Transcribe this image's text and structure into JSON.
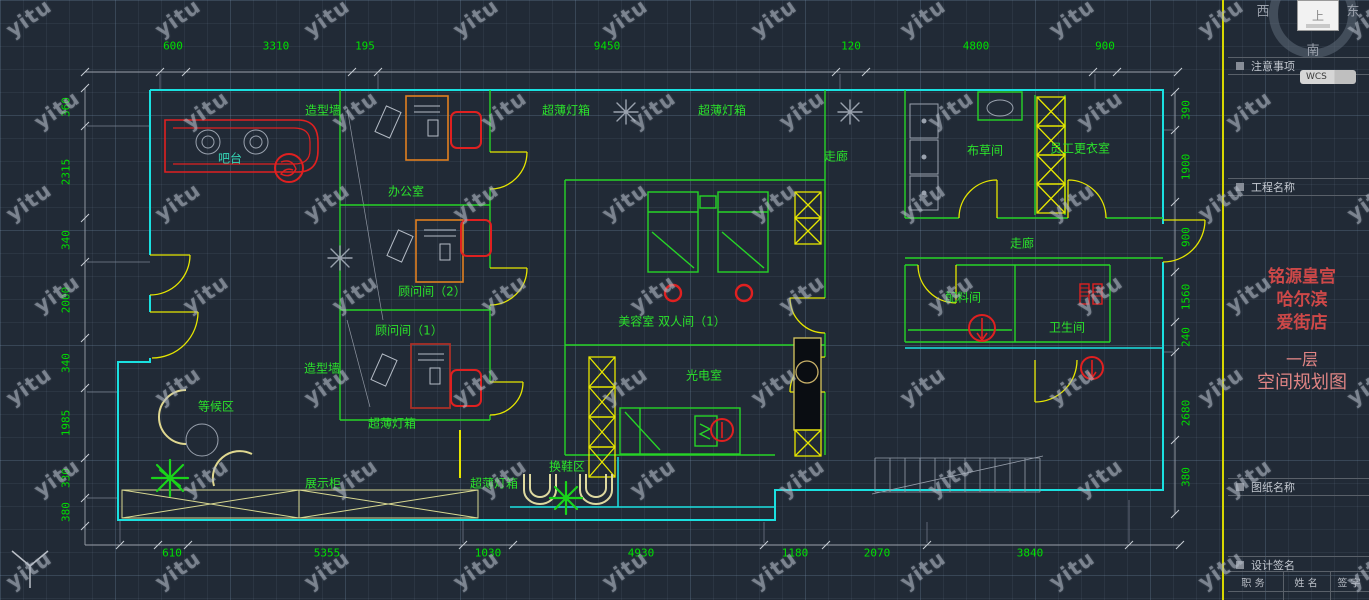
{
  "watermark": {
    "text": "yitu"
  },
  "compass": {
    "west": "西",
    "east": "东",
    "south": "南",
    "top": "上"
  },
  "colors": {
    "walls": "#1ae0e0",
    "partitions": "#27d427",
    "fixtures": "#e6e600",
    "highlight": "#e02020",
    "dim_text": "#00e000",
    "title_red": "#cd4848"
  },
  "sidebar": {
    "wcs_label": "WCS",
    "sections": {
      "notes": "注意事项",
      "project": "工程名称",
      "sheet": "图纸名称",
      "sign": "设计签名"
    },
    "title": {
      "line1": "铭源皇宫",
      "line2": "哈尔滨",
      "line3": "爱街店"
    },
    "subtitle": {
      "line1": "一层",
      "line2": "空间规划图"
    },
    "sign_table": {
      "col1": "职  务",
      "col2": "姓  名",
      "col3": "签  字"
    }
  },
  "dims": {
    "top": [
      "600",
      "3310",
      "195",
      "9450",
      "120",
      "4800",
      "900"
    ],
    "bottom": [
      "610",
      "5355",
      "1030",
      "4930",
      "1180",
      "2070",
      "3840"
    ],
    "left": [
      "360",
      "2315",
      "340",
      "2000",
      "340",
      "1985",
      "330",
      "380"
    ],
    "right": [
      "390",
      "1900",
      "900",
      "1560",
      "240",
      "2680",
      "380"
    ]
  },
  "rooms": [
    {
      "text": "造型墙"
    },
    {
      "text": "吧台"
    },
    {
      "text": "办公室"
    },
    {
      "text": "超薄灯箱"
    },
    {
      "text": "超薄灯箱"
    },
    {
      "text": "走廊"
    },
    {
      "text": "布草间"
    },
    {
      "text": "员工更衣室"
    },
    {
      "text": "顾问间（2）"
    },
    {
      "text": "顾问间（1）"
    },
    {
      "text": "美容室 双人间（1）"
    },
    {
      "text": "走廊"
    },
    {
      "text": "配料间"
    },
    {
      "text": "卫生间"
    },
    {
      "text": "造型墙"
    },
    {
      "text": "光电室"
    },
    {
      "text": "等候区"
    },
    {
      "text": "超薄灯箱"
    },
    {
      "text": "换鞋区"
    },
    {
      "text": "展示柜"
    },
    {
      "text": "超薄灯箱"
    }
  ]
}
